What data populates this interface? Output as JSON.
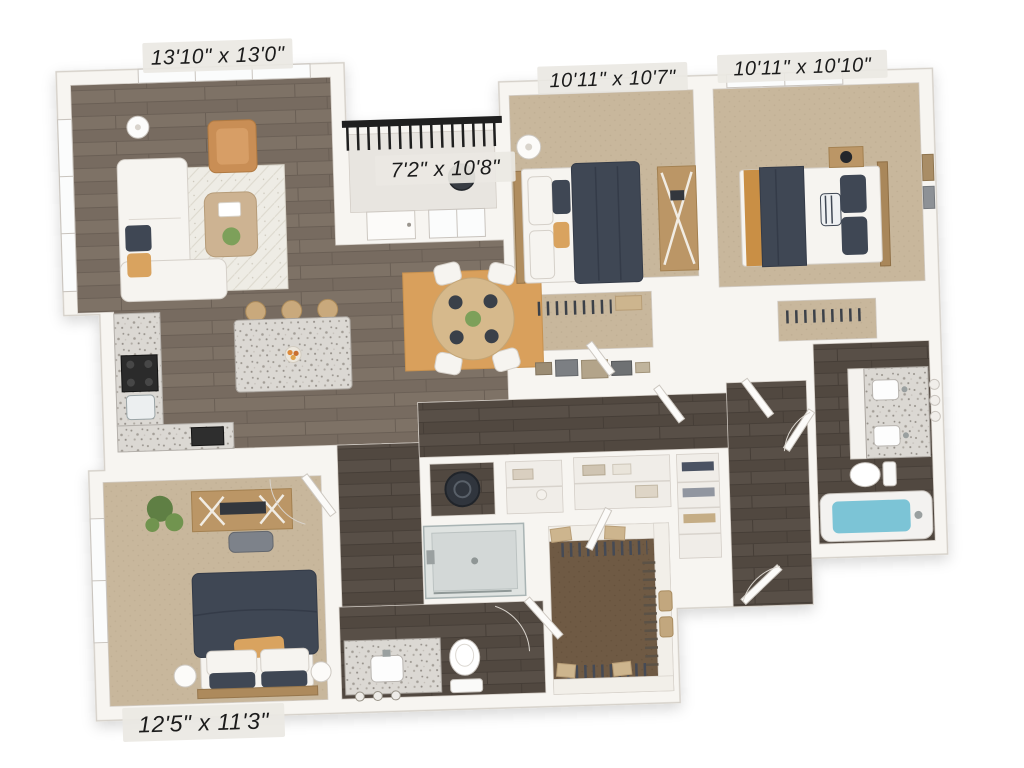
{
  "page": {
    "background": "#ffffff",
    "content": "3D top-down apartment floor plan rendering"
  },
  "floor_plan": {
    "rooms": [
      {
        "id": "living-room",
        "dimensions": "13'10\" x 13'0\""
      },
      {
        "id": "bedroom-2",
        "dimensions": "10'11\" x 10'7\""
      },
      {
        "id": "bedroom-3",
        "dimensions": "10'11\" x 10'10\""
      },
      {
        "id": "balcony",
        "dimensions": "7'2\" x 10'8\""
      },
      {
        "id": "primary-bedroom",
        "dimensions": "12'5\" x 11'3\""
      }
    ],
    "colors": {
      "background": "#ffffff",
      "wall": "#f7f5f1",
      "wall_line": "#d6d1ca",
      "wood_floor": "#7d7165",
      "hall_wood_floor": "#574e46",
      "bedroom_carpet": "#c8b79c",
      "walkin_closet_carpet": "#6f5a44",
      "living_rug": "#eeece5",
      "dining_rug": "#d9a05c",
      "bedding_navy": "#3f4754",
      "accent_orange": "#d9a35f",
      "armchair_leather": "#c98e55",
      "granite_counter": "#dbd8d3",
      "tub_water": "#7cc4d6",
      "balcony_railing": "#1f1f1f",
      "label_text": "#1b1b1b",
      "label_background": "#eae8e3"
    }
  }
}
